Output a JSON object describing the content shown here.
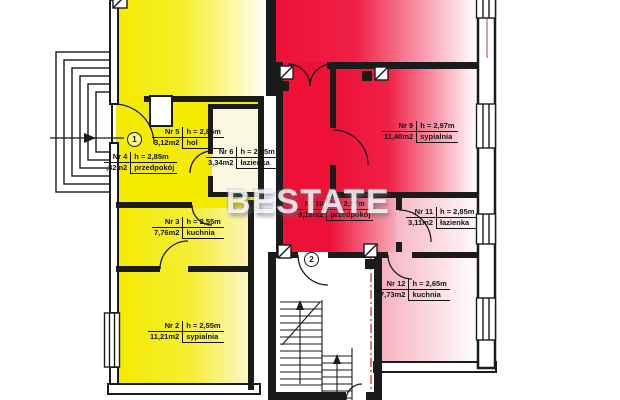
{
  "watermark": {
    "text": "BESTATE"
  },
  "markers": {
    "entrance_1": "1",
    "entrance_2": "2"
  },
  "rooms": {
    "nr2": {
      "nr": "Nr 2",
      "height": "h = 2,55m",
      "area": "11,21m2",
      "name": "sypialnia"
    },
    "nr3": {
      "nr": "Nr 3",
      "height": "h = 2,55m",
      "area": "7,76m2",
      "name": "kuchnia"
    },
    "nr4": {
      "nr": "Nr 4",
      "height": "h = 2,85m",
      "area": ",82m2",
      "name": "przedpokój"
    },
    "nr5": {
      "nr": "Nr 5",
      "height": "h = 2,85m",
      "area": "3,12m2",
      "name": "hol"
    },
    "nr6": {
      "nr": "Nr 6",
      "height": "h = 2,85m",
      "area": "3,34m2",
      "name": "łazienka"
    },
    "nr9": {
      "nr": "Nr 9",
      "height": "h = 2,97m",
      "area": "11,40m2",
      "name": "sypialnia"
    },
    "nr10": {
      "nr": "Nr 10",
      "height": "h = 2,97m",
      "area": "9,19m2",
      "name": "przedpokój"
    },
    "nr11": {
      "nr": "Nr 11",
      "height": "h = 2,85m",
      "area": "3,11m2",
      "name": "łazienka"
    },
    "nr12": {
      "nr": "Nr 12",
      "height": "h = 2,65m",
      "area": "7,73m2",
      "name": "kuchnia"
    }
  },
  "colors": {
    "apartment_left_yellow": "#f3eb00",
    "apartment_right_red": "#ee1036",
    "wall": "#1b1b1b",
    "boundary_line": "#cc2222",
    "watermark_text": "#ffffff"
  }
}
